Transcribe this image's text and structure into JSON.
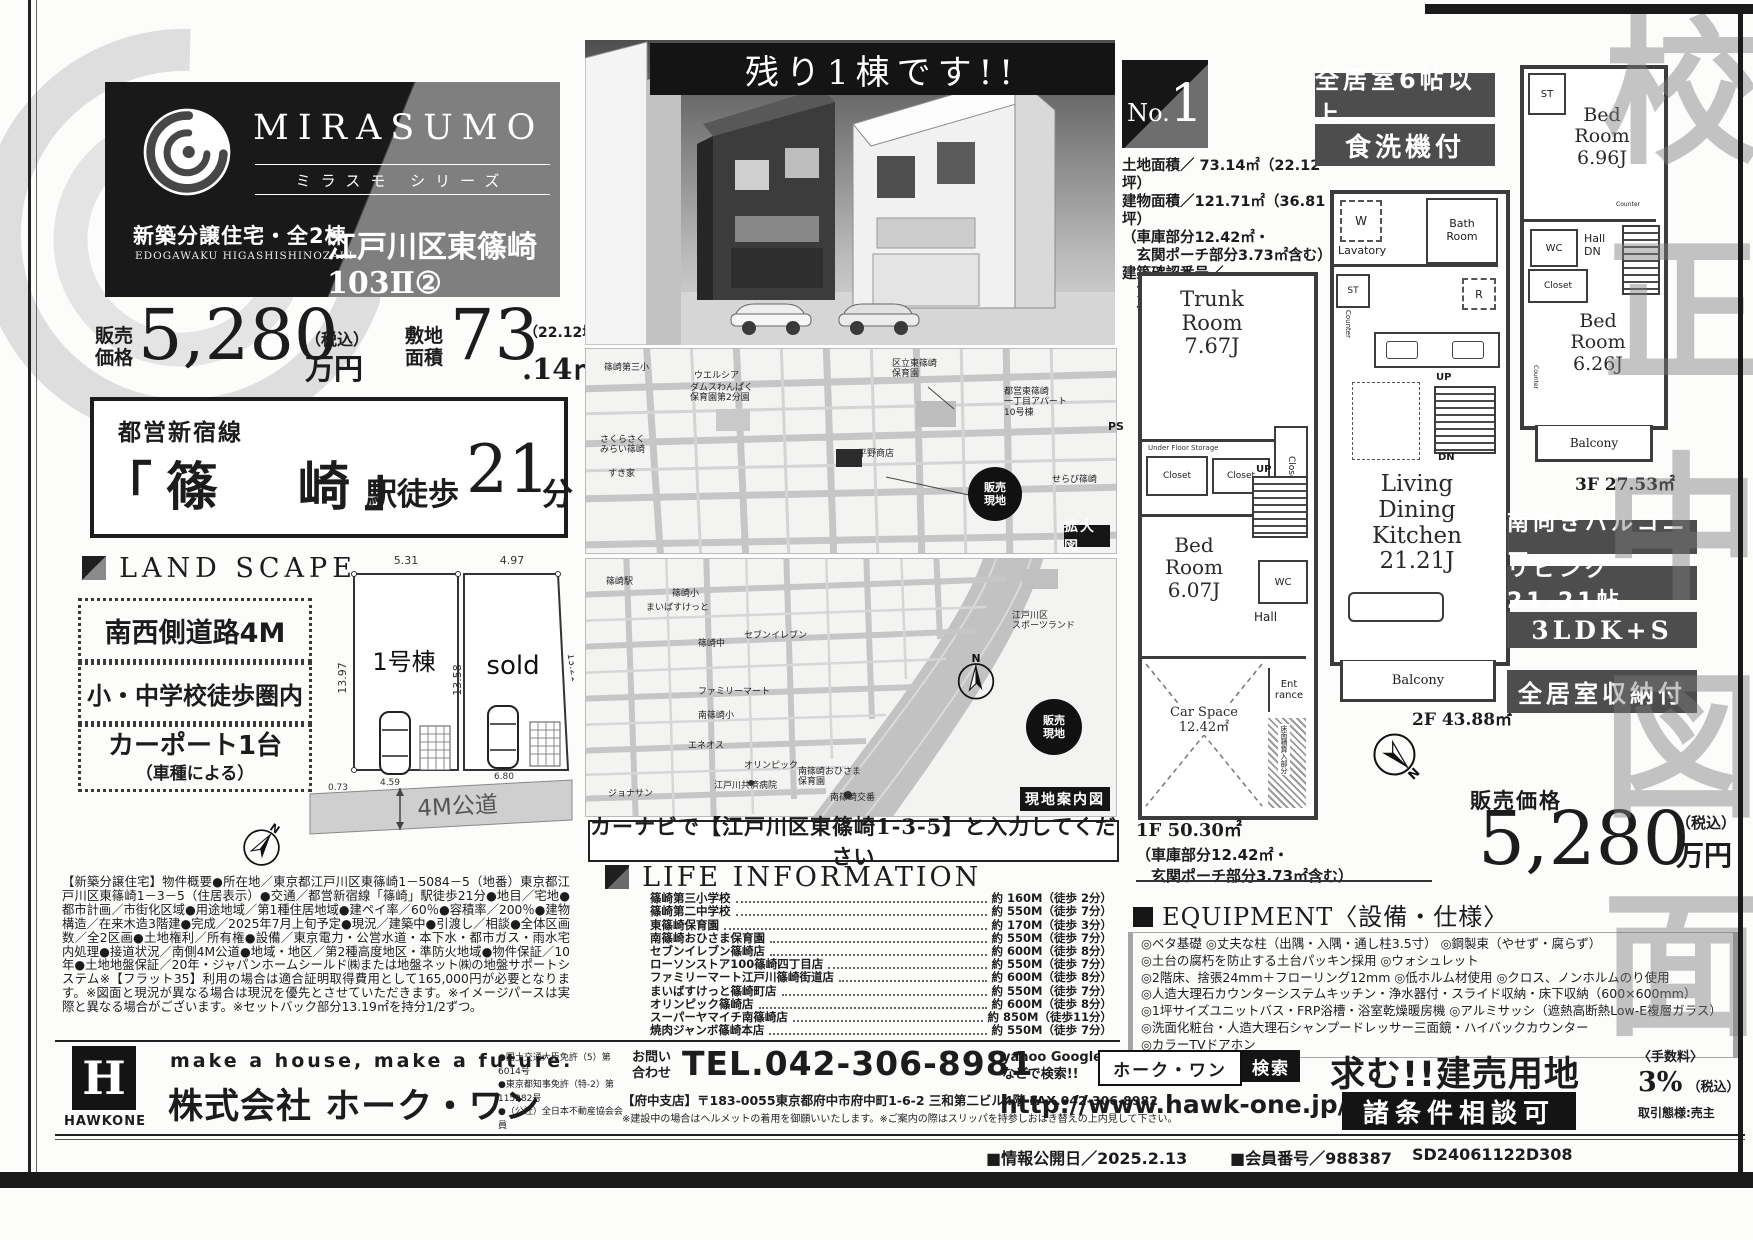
{
  "watermark": {
    "proof": "校正中図面"
  },
  "brand": {
    "name": "MIRASUMO",
    "series": "ミラスモ シリーズ",
    "category": "新築分譲住宅・全2棟",
    "category_en": "EDOGAWAKU HIGASHISHINOZAKI",
    "project": "江戸川区東篠崎103Ⅱ②"
  },
  "price": {
    "label": "販売\n価格",
    "value": "5,280",
    "tax": "（税込）",
    "unit": "万円"
  },
  "site": {
    "label": "敷地\n面積",
    "value": "73",
    "decimal": ".14",
    "unit": "㎡",
    "tsubo": "（22.12坪）"
  },
  "station": {
    "line": "都営新宿線",
    "name": "「篠　崎」",
    "walk": "駅徒歩",
    "minutes": "21",
    "unit": "分"
  },
  "landscape": {
    "title": "LAND SCAPE",
    "features": [
      "南西側道路4M",
      "小・中学校徒歩圏内",
      "カーポート1台",
      "（車種による）"
    ]
  },
  "plot": {
    "lot1": "1号棟",
    "lot2": "sold",
    "road": "4M公道",
    "d_top1": "5.31",
    "d_top2": "4.97",
    "d_left": "13.97",
    "d_mid": "13.58",
    "d_right": "13.21",
    "d_b1": "0.73",
    "d_b2": "4.59",
    "d_b3": "6.80"
  },
  "overview": "【新築分譲住宅】物件概要●所在地／東京都江戸川区東篠崎1－5084－5（地番）東京都江戸川区東篠崎1－3－5（住居表示）●交通／都営新宿線「篠崎」駅徒歩21分●地目／宅地●都市計画／市街化区域●用途地域／第1種住居地域●建ペイ率／60％●容積率／200％●建物構造／在来木造3階建●完成／2025年7月上旬予定●現況／建築中●引渡し／相談●全体区画数／全2区画●土地権利／所有権●設備／東京電力・公営水道・本下水・都市ガス・雨水宅内処理●接道状況／南側4M公道●地域・地区／第2種高度地区・準防火地域●物件保証／10年●土地地盤保証／20年・ジャパンホームシールド㈱または地盤ネット㈱の地盤サポートシステム※【フラット35】利用の場合は適合証明取得費用として165,000円が必要となります。※図面と現況が異なる場合は現況を優先とさせていただきます。※イメージパースは実際と異なる場合がございます。※セットバック部分13.19㎡を持分1/2ずつ。",
  "promo": {
    "banner": "残り1棟です!!"
  },
  "maps": {
    "zoom_tag": "拡大図",
    "guide_tag": "現地案内図",
    "site_mark": "販売\n現地",
    "carnav": "カーナビで【江戸川区東篠崎1-3-5】と入力してください",
    "zoom_labels": [
      "篠崎第三小",
      "ウエルシア",
      "ダムスわんぱく\n保育園第2分園",
      "さくらさく\nみらい篠崎",
      "すき家",
      "区立東篠崎\n保育園",
      "都営東篠崎\n一丁目アパート\n10号棟",
      "平野商店",
      "せらび篠崎"
    ],
    "guide_labels": [
      "篠崎駅",
      "篠崎小",
      "まいばすけっと",
      "篠崎中",
      "セブンイレブン",
      "ファミリーマート",
      "南篠崎小",
      "エネオス",
      "オリンピック",
      "ジョナサン",
      "江戸川共済病院",
      "南篠崎おひさま\n保育園",
      "南篠崎交番",
      "江戸川区\nスポーツランド"
    ]
  },
  "life": {
    "title": "LIFE INFORMATION",
    "items": [
      {
        "name": "篠崎第三小学校",
        "dist": "約 160M（徒歩 2分）"
      },
      {
        "name": "篠崎第二中学校",
        "dist": "約 550M（徒歩 7分）"
      },
      {
        "name": "東篠崎保育園",
        "dist": "約 170M（徒歩 3分）"
      },
      {
        "name": "南篠崎おひさま保育園",
        "dist": "約 550M（徒歩 7分）"
      },
      {
        "name": "セブンイレブン篠崎店",
        "dist": "約 600M（徒歩 8分）"
      },
      {
        "name": "ローソンストア100篠崎四丁目店",
        "dist": "約 550M（徒歩 7分）"
      },
      {
        "name": "ファミリーマート江戸川篠崎街道店",
        "dist": "約 600M（徒歩 8分）"
      },
      {
        "name": "まいばすけっと篠崎町店",
        "dist": "約 550M（徒歩 7分）"
      },
      {
        "name": "オリンピック篠崎店",
        "dist": "約 600M（徒歩 8分）"
      },
      {
        "name": "スーパーヤマイチ南篠崎店",
        "dist": "約 850M（徒歩11分）"
      },
      {
        "name": "焼肉ジャンボ篠崎本店",
        "dist": "約 550M（徒歩 7分）"
      }
    ]
  },
  "unit": {
    "no_label": "No.",
    "no_value": "1",
    "badge_rooms": "全居室6帖以上",
    "badge_dish": "食洗機付",
    "specs": [
      "土地面積／ 73.14㎡（22.12坪）",
      "建物面積／121.71㎡（36.81坪）",
      "（車庫部分12.42㎡・",
      "　玄関ポーチ部分3.73㎡含む）",
      "建築確認番号／",
      "　第24UDI1T建04344号",
      "　令和7年2月1日"
    ],
    "features": [
      "南向きバルコニー",
      "リビング21.21帖",
      "3LDK+S",
      "全居室収納付"
    ],
    "f1_area": "1F 50.30㎡",
    "f1_note1": "（車庫部分12.42㎡・",
    "f1_note2": "　玄関ポーチ部分3.73㎡含む）",
    "f2_area": "2F 43.88㎡",
    "f3_area": "3F 27.53㎡"
  },
  "plans": {
    "f1": {
      "trunk": "Trunk\nRoom\n7.67J",
      "ufs": "Under Floor Storage",
      "ps": "PS",
      "closet": "Closet",
      "bed": "Bed\nRoom\n6.07J",
      "up": "UP",
      "wc": "WC",
      "hall": "Hall",
      "car": "Car Space\n12.42㎡",
      "entrance": "Ent\nrance",
      "inc": "床面積算入部分"
    },
    "f2": {
      "w": "W",
      "lavatory": "Lavatory",
      "bath": "Bath\nRoom",
      "st": "ST",
      "counter": "Counter",
      "r": "R",
      "up": "UP",
      "dn": "DN",
      "ldk": "Living\nDining\nKitchen\n21.21J",
      "balcony": "Balcony"
    },
    "f3": {
      "st": "ST",
      "bed1": "Bed\nRoom\n6.96J",
      "wc": "WC",
      "hall": "Hall\nDN",
      "closet": "Closet",
      "counter": "Counter",
      "bed2": "Bed\nRoom\n6.26J",
      "balcony": "Balcony"
    }
  },
  "sale": {
    "label": "販売価格",
    "value": "5,280",
    "tax": "（税込）",
    "unit": "万円"
  },
  "equipment": {
    "title": "EQUIPMENT〈設備・仕様〉",
    "items": [
      "◎ベタ基礎 ◎丈夫な柱（出隅・入隅・通し柱3.5寸） ◎鋼製束（やせず・腐らず）",
      "◎土台の腐朽を防止する土台パッキン採用 ◎ウォシュレット",
      "◎2階床、捨張24mm＋フローリング12mm ◎低ホルム材使用 ◎クロス、ノンホルムのり使用",
      "◎人造大理石カウンターシステムキッチン・浄水器付・スライド収納・床下収納（600×600mm）",
      "◎1坪サイズユニットバス・FRP浴槽・浴室乾燥暖房機 ◎アルミサッシ（遮熱高断熱Low-E複層ガラス）",
      "◎洗面化粧台・人造大理石シャンプードレッサー三面鏡・ハイバックカウンター",
      "◎カラーTVドアホン"
    ]
  },
  "footer": {
    "logo_letter": "H",
    "logo_name": "HAWKONE",
    "slogan": "make a house, make a future.",
    "company": "株式会社 ホーク・ワン",
    "licenses": [
      "●国土交通大臣免許（5）第6014号",
      "●東京都知事免許（特-2）第115282号",
      "●（公社）全日本不動産協会会員"
    ],
    "contact_label": "お問い\n合わせ",
    "tel": "TEL.042-306-8981",
    "address": "【府中支店】〒183-0055東京都府中市府中町1-6-2 三和第二ビル4階 FAX.042-306-8982",
    "note": "※建設中の場合はヘルメットの着用を御願いいたします。※ご案内の際はスリッパを持参しおはき替えの上内見して下さい。",
    "search_hint": "yahoo Google\nなどで検索!!",
    "search_box": "ホーク・ワン",
    "search_button": "検索",
    "url": "http://www.hawk-one.jp/",
    "wanted": "求む!!建売用地",
    "consult": "諸条件相談可",
    "fee_label": "〈手数料〉",
    "fee_value": "3%",
    "fee_tax": "（税込）",
    "deal": "取引態様:売主",
    "published": "■情報公開日／2025.2.13",
    "member": "■会員番号／988387",
    "code": "SD24061122D308"
  },
  "compass": {
    "n": "N"
  }
}
